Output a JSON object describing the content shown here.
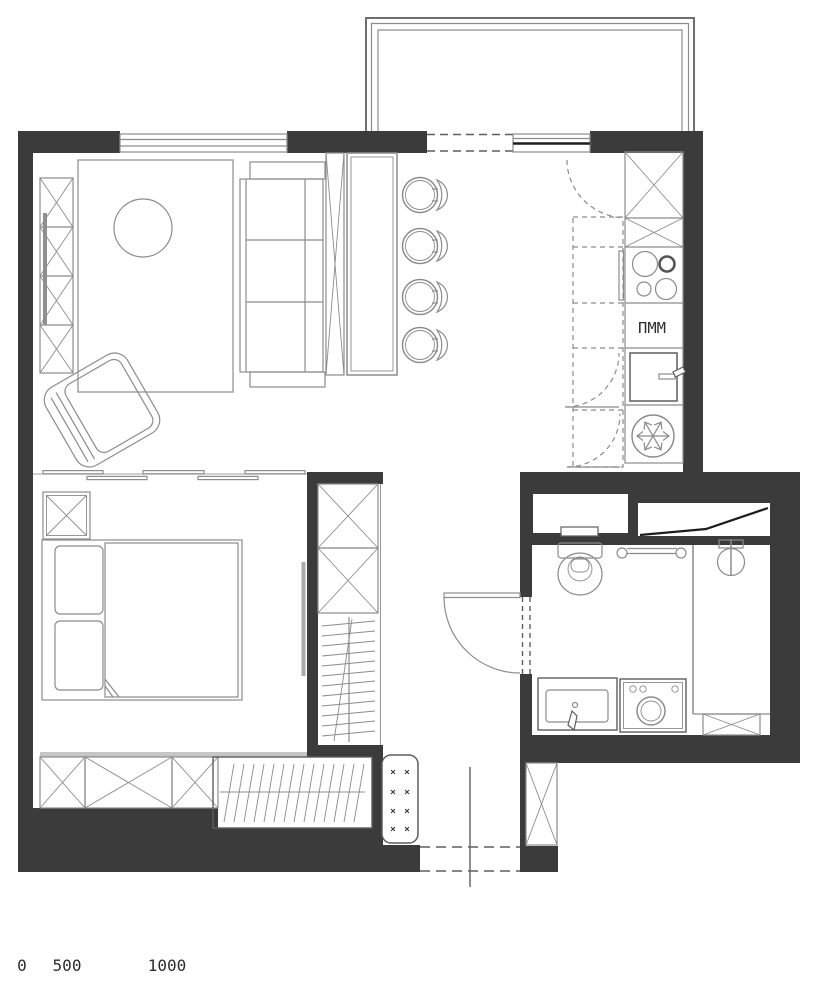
{
  "plan": {
    "labels": {
      "dishwasher": "ПММ"
    },
    "scale_bar": {
      "tick_0": "0",
      "tick_500": "500",
      "tick_1000": "1000"
    },
    "colors": {
      "wall": "#3b3b3b",
      "furniture_line": "#8c8c8c",
      "dark_accent": "#1d1d1d",
      "track_light": "#c6c6c6",
      "background": "#ffffff"
    },
    "icons": {
      "freezer": "snowflake-icon",
      "stove": "four-burners-icon",
      "toilet": "toilet-icon",
      "shower": "shower-mixer-icon",
      "sink": "sink-icon",
      "washing_machine": "washing-machine-icon",
      "radiator": "radiator-icon",
      "bar_stools": "stool-icon",
      "doors": "door-swing-icon",
      "wardrobes": "x-cabinet-icon"
    }
  }
}
